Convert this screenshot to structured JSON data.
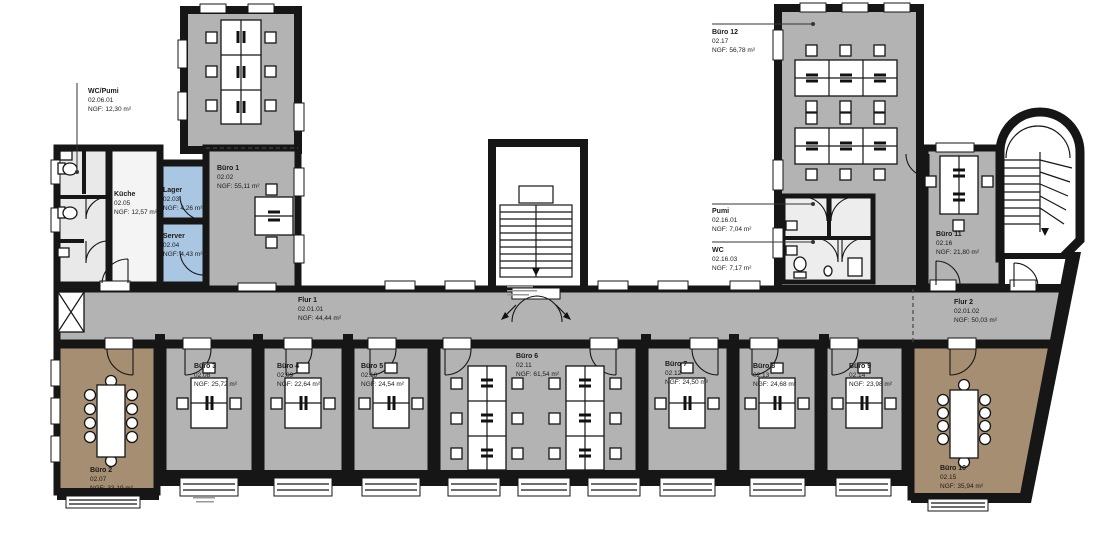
{
  "rooms": {
    "flur1": {
      "name": "Flur 1",
      "number": "02.01.01",
      "area": "NGF: 44,44 m²"
    },
    "flur2": {
      "name": "Flur 2",
      "number": "02.01.02",
      "area": "NGF: 50,03 m²"
    },
    "buero1": {
      "name": "Büro 1",
      "number": "02.02",
      "area": "NGF: 55,11 m²"
    },
    "lager": {
      "name": "Lager",
      "number": "02.03",
      "area": "NGF: 4,26 m²"
    },
    "server": {
      "name": "Server",
      "number": "02.04",
      "area": "NGF: 4,43 m²"
    },
    "kueche": {
      "name": "Küche",
      "number": "02.05",
      "area": "NGF: 12,57 m²"
    },
    "wc_pumi": {
      "name": "WC/Pumi",
      "number": "02.06.01",
      "area": "NGF: 12,30 m²"
    },
    "buero2": {
      "name": "Büro 2",
      "number": "02.07",
      "area": "NGF: 33,19 m²"
    },
    "buero3": {
      "name": "Büro 3",
      "number": "02.08",
      "area": "NGF: 25,72 m²"
    },
    "buero4": {
      "name": "Büro 4",
      "number": "02.09",
      "area": "NGF: 22,64 m²"
    },
    "buero5": {
      "name": "Büro 5",
      "number": "02.10",
      "area": "NGF: 24,54 m²"
    },
    "buero6": {
      "name": "Büro 6",
      "number": "02.11",
      "area": "NGF: 61,54 m²"
    },
    "buero7": {
      "name": "Büro 7",
      "number": "02.12",
      "area": "NGF: 24,50 m²"
    },
    "buero8": {
      "name": "Büro 8",
      "number": "02.13",
      "area": "NGF: 24,68 m²"
    },
    "buero9": {
      "name": "Büro 9",
      "number": "02.14",
      "area": "NGF: 23,98 m²"
    },
    "buero10": {
      "name": "Büro 10",
      "number": "02.15",
      "area": "NGF: 35,94 m²"
    },
    "buero11": {
      "name": "Büro 11",
      "number": "02.16",
      "area": "NGF: 21,80 m²"
    },
    "pumi": {
      "name": "Pumi",
      "number": "02.16.01",
      "area": "NGF: 7,04 m²"
    },
    "wc": {
      "name": "WC",
      "number": "02.16.03",
      "area": "NGF: 7,17 m²"
    },
    "buero12": {
      "name": "Büro 12",
      "number": "02.17",
      "area": "NGF: 56,78 m²"
    }
  },
  "colors": {
    "office_gray": "#b3b3b3",
    "meeting_brown": "#a68e72",
    "tech_blue": "#a9c7e3",
    "wet_light": "#e9e9e9",
    "wall": "#161616"
  }
}
